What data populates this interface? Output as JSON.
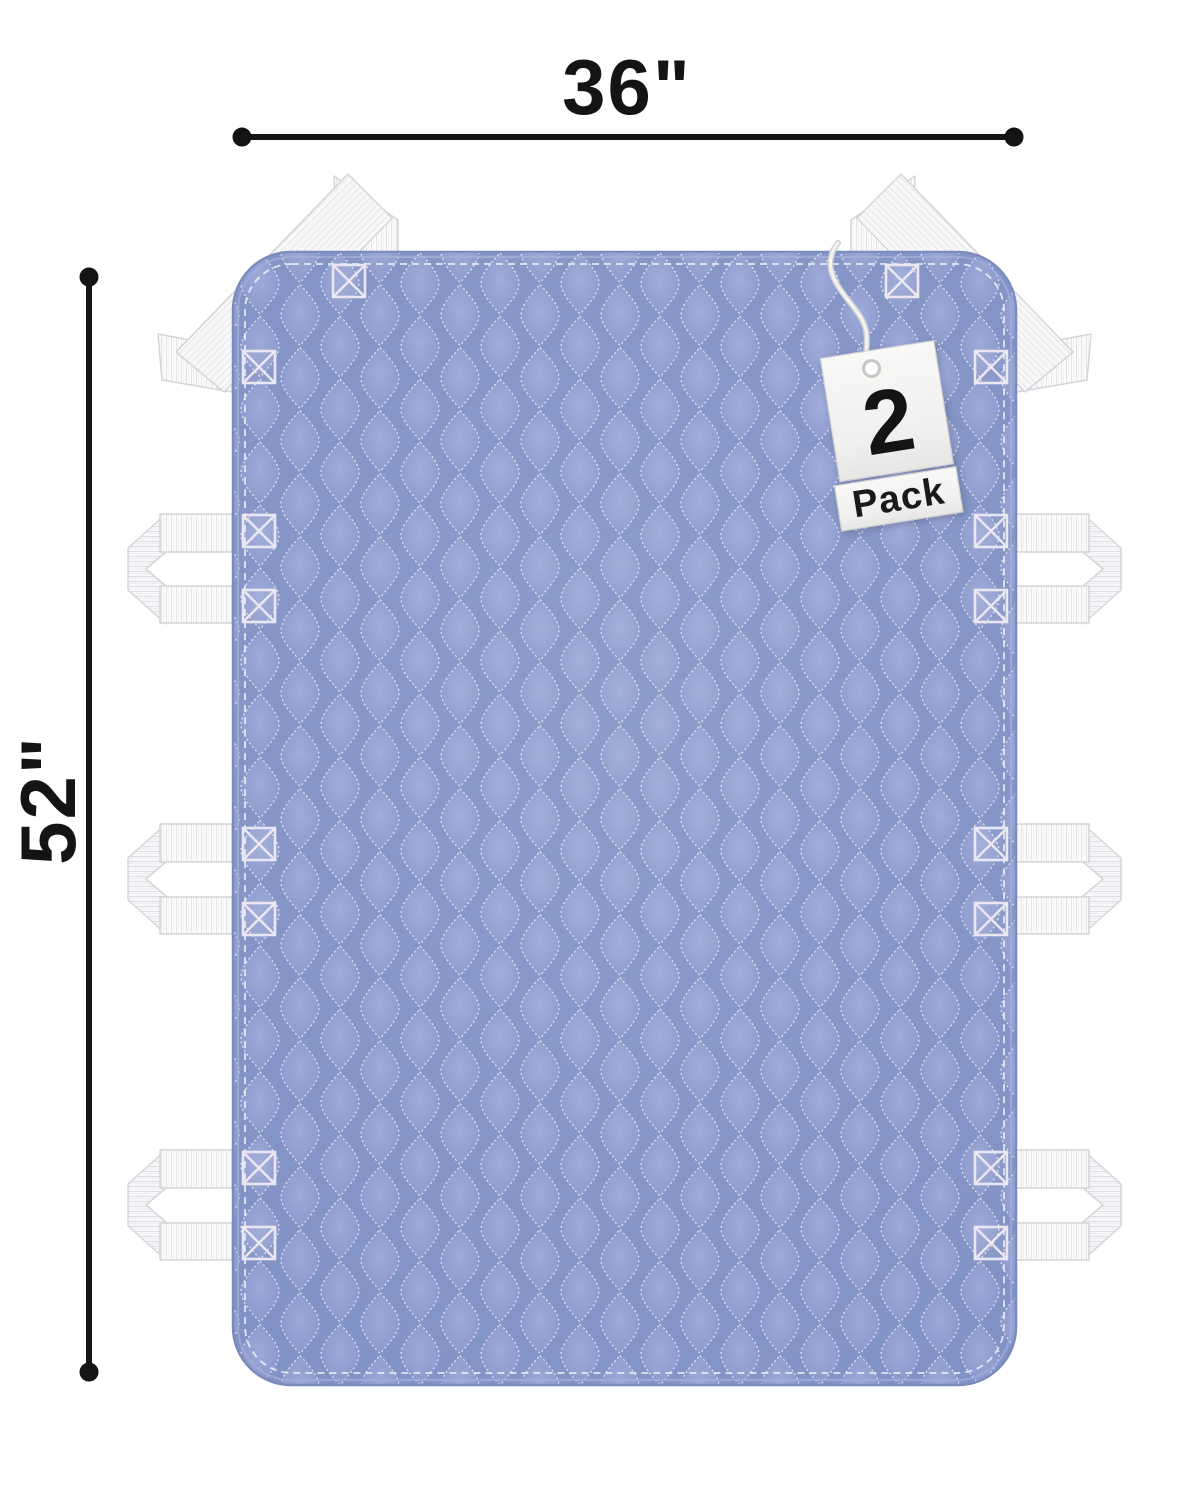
{
  "product": {
    "description": "quilted bed positioning pad with lift handles",
    "pad_color": "#8D9BCC",
    "strap_color": "#FAFAFB",
    "stitch_color": "#EBE7F2",
    "handles": {
      "left": 3,
      "right": 3,
      "top_corners": 2
    }
  },
  "annotations": {
    "width_label": "36\"",
    "height_label": "52\"",
    "line_color": "#141414"
  },
  "tag": {
    "quantity": "2",
    "unit": "Pack",
    "card_color": "#F4F4F2",
    "text_color": "#1A1A1A"
  }
}
